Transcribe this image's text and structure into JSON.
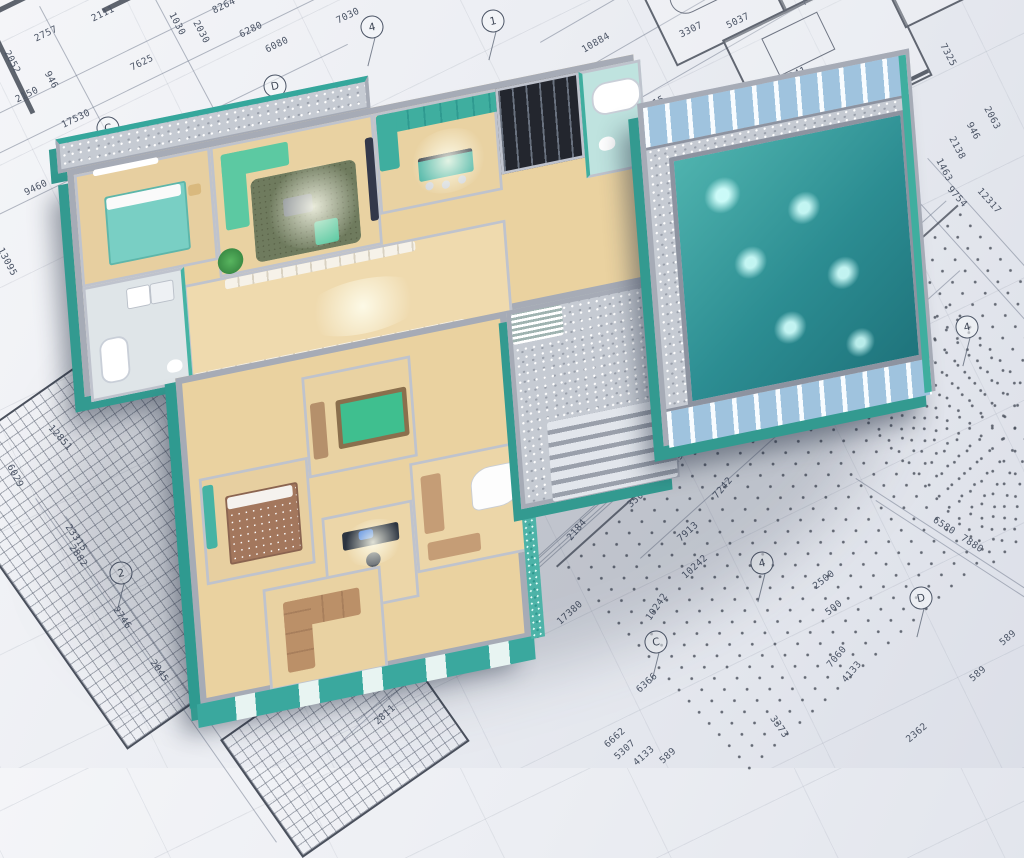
{
  "palette": {
    "paper": "#eceef3",
    "line": "#4c5566",
    "teal_wall": "#3fae9f",
    "teal_dark": "#2f9a90",
    "wall_top_gray": "#a6abb6",
    "wood_floor": "#ead2a0",
    "green_sofa": "#5cc9a2",
    "pool_water": "#2c8d92",
    "glass_blue": "#9fc3de",
    "brown_furniture": "#b5906b"
  },
  "annotations": {
    "dimensions": [
      {
        "t": "2111",
        "x": 103,
        "y": 14,
        "r": -26
      },
      {
        "t": "2757",
        "x": 46,
        "y": 34,
        "r": -26
      },
      {
        "t": "946",
        "x": 51,
        "y": 80,
        "r": 62
      },
      {
        "t": "2150",
        "x": 27,
        "y": 95,
        "r": -26
      },
      {
        "t": "2052",
        "x": 12,
        "y": 62,
        "r": 62
      },
      {
        "t": "7625",
        "x": 142,
        "y": 63,
        "r": -26
      },
      {
        "t": "17530",
        "x": 76,
        "y": 119,
        "r": -26
      },
      {
        "t": "9460",
        "x": 36,
        "y": 188,
        "r": -26
      },
      {
        "t": "7925",
        "x": 226,
        "y": 133,
        "r": 48
      },
      {
        "t": "13095",
        "x": 7,
        "y": 262,
        "r": 62
      },
      {
        "t": "12884",
        "x": 105,
        "y": 393,
        "r": 48
      },
      {
        "t": "12851",
        "x": 60,
        "y": 438,
        "r": 48
      },
      {
        "t": "6029",
        "x": 15,
        "y": 476,
        "r": 62
      },
      {
        "t": "23315",
        "x": 76,
        "y": 538,
        "r": 55
      },
      {
        "t": "2882",
        "x": 78,
        "y": 556,
        "r": 55
      },
      {
        "t": "2746",
        "x": 122,
        "y": 618,
        "r": 55
      },
      {
        "t": "2045",
        "x": 159,
        "y": 671,
        "r": 55
      },
      {
        "t": "9129",
        "x": 218,
        "y": 634,
        "r": 55
      },
      {
        "t": "8264",
        "x": 224,
        "y": 6,
        "r": -26
      },
      {
        "t": "1030",
        "x": 177,
        "y": 24,
        "r": 62
      },
      {
        "t": "2030",
        "x": 201,
        "y": 32,
        "r": 62
      },
      {
        "t": "6280",
        "x": 251,
        "y": 30,
        "r": -26
      },
      {
        "t": "6080",
        "x": 277,
        "y": 45,
        "r": -26
      },
      {
        "t": "7030",
        "x": 348,
        "y": 16,
        "r": -26
      },
      {
        "t": "10884",
        "x": 596,
        "y": 43,
        "r": -30
      },
      {
        "t": "12051",
        "x": 560,
        "y": 85,
        "r": -30
      },
      {
        "t": "23315",
        "x": 651,
        "y": 106,
        "r": -30
      },
      {
        "t": "3307",
        "x": 691,
        "y": 30,
        "r": -26
      },
      {
        "t": "5037",
        "x": 738,
        "y": 21,
        "r": -26
      },
      {
        "t": "1341",
        "x": 795,
        "y": 75,
        "r": -26
      },
      {
        "t": "4941",
        "x": 785,
        "y": 97,
        "r": -26
      },
      {
        "t": "3451",
        "x": 853,
        "y": 88,
        "r": 62
      },
      {
        "t": "3590",
        "x": 875,
        "y": 131,
        "r": 62
      },
      {
        "t": "5444",
        "x": 865,
        "y": 170,
        "r": 62
      },
      {
        "t": "4133",
        "x": 904,
        "y": 201,
        "r": 62
      },
      {
        "t": "1463",
        "x": 944,
        "y": 170,
        "r": 62
      },
      {
        "t": "2138",
        "x": 957,
        "y": 148,
        "r": 62
      },
      {
        "t": "946",
        "x": 973,
        "y": 131,
        "r": 62
      },
      {
        "t": "2063",
        "x": 992,
        "y": 118,
        "r": 62
      },
      {
        "t": "7325",
        "x": 948,
        "y": 55,
        "r": 62
      },
      {
        "t": "9754",
        "x": 957,
        "y": 197,
        "r": 48
      },
      {
        "t": "12317",
        "x": 989,
        "y": 201,
        "r": 48
      },
      {
        "t": "1363",
        "x": 881,
        "y": 226,
        "r": 62
      },
      {
        "t": "7181",
        "x": 873,
        "y": 291,
        "r": 48
      },
      {
        "t": "9129",
        "x": 728,
        "y": 195,
        "r": -26
      },
      {
        "t": "2184",
        "x": 669,
        "y": 437,
        "r": -50
      },
      {
        "t": "1563",
        "x": 682,
        "y": 454,
        "r": -50
      },
      {
        "t": "3257",
        "x": 623,
        "y": 473,
        "r": -42
      },
      {
        "t": "3500",
        "x": 638,
        "y": 498,
        "r": -42
      },
      {
        "t": "7242",
        "x": 723,
        "y": 488,
        "r": -50
      },
      {
        "t": "2184",
        "x": 577,
        "y": 530,
        "r": -50
      },
      {
        "t": "2811",
        "x": 528,
        "y": 575,
        "r": -42
      },
      {
        "t": "17380",
        "x": 570,
        "y": 613,
        "r": -42
      },
      {
        "t": "4133",
        "x": 457,
        "y": 636,
        "r": -42
      },
      {
        "t": "12317",
        "x": 485,
        "y": 648,
        "r": -42
      },
      {
        "t": "6366",
        "x": 647,
        "y": 683,
        "r": -42
      },
      {
        "t": "10242",
        "x": 657,
        "y": 607,
        "r": -55
      },
      {
        "t": "2811",
        "x": 385,
        "y": 715,
        "r": -42
      },
      {
        "t": "6662",
        "x": 615,
        "y": 738,
        "r": -42
      },
      {
        "t": "5307",
        "x": 625,
        "y": 750,
        "r": -42
      },
      {
        "t": "4133",
        "x": 644,
        "y": 756,
        "r": -42
      },
      {
        "t": "589",
        "x": 668,
        "y": 756,
        "r": -42
      },
      {
        "t": "7913",
        "x": 688,
        "y": 532,
        "r": -42
      },
      {
        "t": "10242",
        "x": 695,
        "y": 567,
        "r": -42
      },
      {
        "t": "2500",
        "x": 824,
        "y": 580,
        "r": -38
      },
      {
        "t": "500",
        "x": 834,
        "y": 608,
        "r": -38
      },
      {
        "t": "7060",
        "x": 837,
        "y": 657,
        "r": -50
      },
      {
        "t": "4133",
        "x": 852,
        "y": 672,
        "r": -50
      },
      {
        "t": "3373",
        "x": 779,
        "y": 727,
        "r": 55
      },
      {
        "t": "2362",
        "x": 917,
        "y": 733,
        "r": -40
      },
      {
        "t": "589",
        "x": 1008,
        "y": 638,
        "r": -40
      },
      {
        "t": "589",
        "x": 978,
        "y": 674,
        "r": -40
      },
      {
        "t": "6580",
        "x": 944,
        "y": 526,
        "r": 33
      },
      {
        "t": "7880",
        "x": 972,
        "y": 544,
        "r": 33
      }
    ],
    "grid_markers": [
      {
        "t": "C",
        "x": 108,
        "y": 128,
        "r": -12
      },
      {
        "t": "D",
        "x": 275,
        "y": 86,
        "r": -12
      },
      {
        "t": "4",
        "x": 372,
        "y": 27,
        "r": -12
      },
      {
        "t": "1",
        "x": 493,
        "y": 21,
        "r": -12
      },
      {
        "t": "2",
        "x": 671,
        "y": 135,
        "r": -12
      },
      {
        "t": "3",
        "x": 826,
        "y": 236,
        "r": -12
      },
      {
        "t": "4",
        "x": 967,
        "y": 327,
        "r": -12
      },
      {
        "t": "2",
        "x": 121,
        "y": 573,
        "r": -12
      },
      {
        "t": "C",
        "x": 656,
        "y": 642,
        "r": -12
      },
      {
        "t": "4",
        "x": 762,
        "y": 563,
        "r": -12
      },
      {
        "t": "D",
        "x": 921,
        "y": 598,
        "r": -12
      }
    ]
  }
}
